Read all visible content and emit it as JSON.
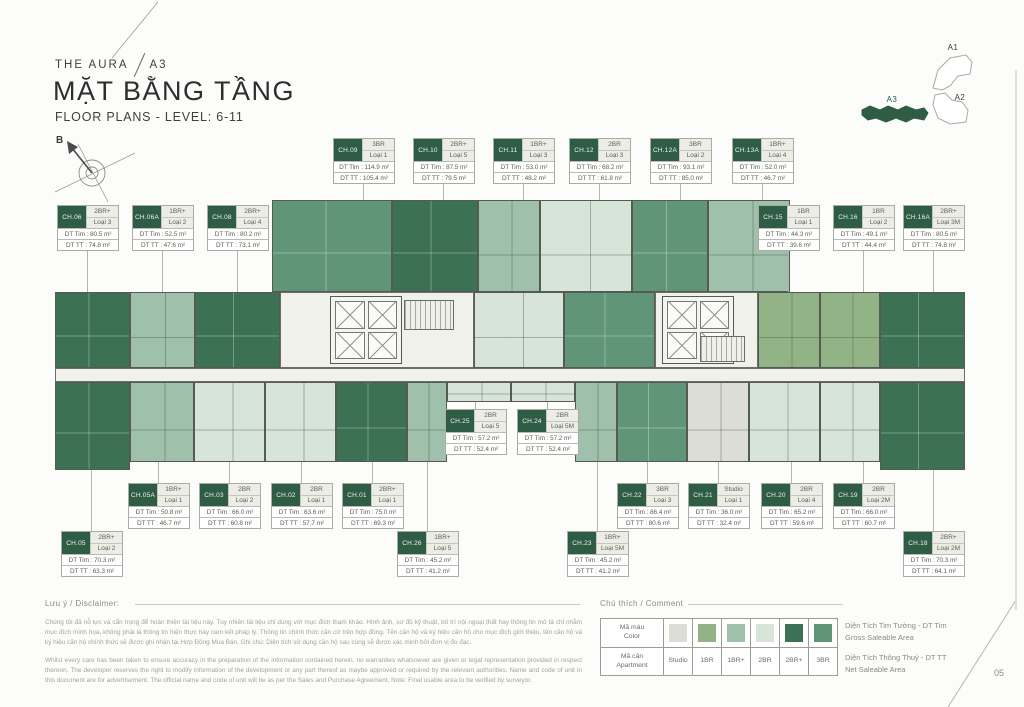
{
  "header": {
    "project": "THE AURA",
    "block": "A3",
    "title": "MẶT BẰNG TẦNG",
    "subtitle": "FLOOR PLANS - LEVEL: 6-11",
    "compass_label": "B"
  },
  "minimap": {
    "a1": "A1",
    "a2": "A2",
    "a3": "A3"
  },
  "page_number": "05",
  "labels": {
    "dt_tim": "DT Tim",
    "dt_tt": "DT TT",
    "m2": "m²"
  },
  "units": [
    {
      "code": "CH.09",
      "type": "3BR",
      "loai": "Loại 1",
      "tim": "114.9",
      "tt": "105.4",
      "x": 333,
      "y": 138,
      "dir": "down",
      "line": 18
    },
    {
      "code": "CH.10",
      "type": "2BR+",
      "loai": "Loại 5",
      "tim": "87.5",
      "tt": "79.5",
      "x": 413,
      "y": 138,
      "dir": "down",
      "line": 18
    },
    {
      "code": "CH.11",
      "type": "1BR+",
      "loai": "Loại 3",
      "tim": "53.0",
      "tt": "48.2",
      "x": 493,
      "y": 138,
      "dir": "down",
      "line": 18
    },
    {
      "code": "CH.12",
      "type": "2BR",
      "loai": "Loại 3",
      "tim": "68.2",
      "tt": "61.8",
      "x": 569,
      "y": 138,
      "dir": "down",
      "line": 18
    },
    {
      "code": "CH.12A",
      "type": "3BR",
      "loai": "Loại 2",
      "tim": "93.1",
      "tt": "85.0",
      "x": 650,
      "y": 138,
      "dir": "down",
      "line": 18
    },
    {
      "code": "CH.13A",
      "type": "1BR+",
      "loai": "Loại 4",
      "tim": "52.0",
      "tt": "46.7",
      "x": 732,
      "y": 138,
      "dir": "down",
      "line": 18
    },
    {
      "code": "CH.06",
      "type": "2BR+",
      "loai": "Loại 3",
      "tim": "80.5",
      "tt": "74.8",
      "x": 57,
      "y": 205,
      "dir": "down",
      "line": 43
    },
    {
      "code": "CH.06A",
      "type": "1BR+",
      "loai": "Loại 2",
      "tim": "52.5",
      "tt": "47.6",
      "x": 132,
      "y": 205,
      "dir": "down",
      "line": 43
    },
    {
      "code": "CH.08",
      "type": "2BR+",
      "loai": "Loại 4",
      "tim": "80.2",
      "tt": "73.1",
      "x": 207,
      "y": 205,
      "dir": "down",
      "line": 43
    },
    {
      "code": "CH.15",
      "type": "1BR",
      "loai": "Loại 1",
      "tim": "44.3",
      "tt": "39.6",
      "x": 758,
      "y": 205,
      "dir": "down",
      "line": 43
    },
    {
      "code": "CH.16",
      "type": "1BR",
      "loai": "Loại 2",
      "tim": "49.1",
      "tt": "44.4",
      "x": 833,
      "y": 205,
      "dir": "down",
      "line": 43
    },
    {
      "code": "CH.16A",
      "type": "2BR+",
      "loai": "Loại 3M",
      "tim": "80.5",
      "tt": "74.8",
      "x": 903,
      "y": 205,
      "dir": "down",
      "line": 43
    },
    {
      "code": "CH.25",
      "type": "2BR",
      "loai": "Loại 5",
      "tim": "57.2",
      "tt": "52.4",
      "x": 445,
      "y": 409,
      "dir": "up",
      "line": 7
    },
    {
      "code": "CH.24",
      "type": "2BR",
      "loai": "Loại 5M",
      "tim": "57.2",
      "tt": "52.4",
      "x": 517,
      "y": 409,
      "dir": "up",
      "line": 7
    },
    {
      "code": "CH.05A",
      "type": "1BR+",
      "loai": "Loại 1",
      "tim": "50.8",
      "tt": "46.7",
      "x": 128,
      "y": 483,
      "dir": "up",
      "line": 21
    },
    {
      "code": "CH.03",
      "type": "2BR",
      "loai": "Loại 2",
      "tim": "66.0",
      "tt": "60.8",
      "x": 199,
      "y": 483,
      "dir": "up",
      "line": 21
    },
    {
      "code": "CH.02",
      "type": "2BR",
      "loai": "Loại 1",
      "tim": "63.6",
      "tt": "57.7",
      "x": 271,
      "y": 483,
      "dir": "up",
      "line": 21
    },
    {
      "code": "CH.01",
      "type": "2BR+",
      "loai": "Loại 1",
      "tim": "75.0",
      "tt": "69.3",
      "x": 342,
      "y": 483,
      "dir": "up",
      "line": 21
    },
    {
      "code": "CH.22",
      "type": "3BR",
      "loai": "Loại 3",
      "tim": "86.4",
      "tt": "80.6",
      "x": 617,
      "y": 483,
      "dir": "up",
      "line": 21
    },
    {
      "code": "CH.21",
      "type": "Studio",
      "loai": "Loại 1",
      "tim": "36.0",
      "tt": "32.4",
      "x": 688,
      "y": 483,
      "dir": "up",
      "line": 21
    },
    {
      "code": "CH.20",
      "type": "2BR",
      "loai": "Loại 4",
      "tim": "65.2",
      "tt": "59.6",
      "x": 761,
      "y": 483,
      "dir": "up",
      "line": 21
    },
    {
      "code": "CH.19",
      "type": "2BR",
      "loai": "Loại 2M",
      "tim": "66.0",
      "tt": "60.7",
      "x": 833,
      "y": 483,
      "dir": "up",
      "line": 21
    },
    {
      "code": "CH.05",
      "type": "2BR+",
      "loai": "Loại 2",
      "tim": "70.3",
      "tt": "63.3",
      "x": 61,
      "y": 531,
      "dir": "up",
      "line": 61
    },
    {
      "code": "CH.26",
      "type": "1BR+",
      "loai": "Loại 5",
      "tim": "45.2",
      "tt": "41.2",
      "x": 397,
      "y": 531,
      "dir": "up",
      "line": 69
    },
    {
      "code": "CH.23",
      "type": "1BR+",
      "loai": "Loại 5M",
      "tim": "45.2",
      "tt": "41.2",
      "x": 567,
      "y": 531,
      "dir": "up",
      "line": 69
    },
    {
      "code": "CH.18",
      "type": "2BR+",
      "loai": "Loại 2M",
      "tim": "70.3",
      "tt": "64.1",
      "x": 903,
      "y": 531,
      "dir": "up",
      "line": 61
    }
  ],
  "floorplan": {
    "blocks": [
      {
        "x": 272,
        "y": 200,
        "w": 120,
        "h": 92,
        "t": "3BR",
        "u": "CH.09"
      },
      {
        "x": 392,
        "y": 200,
        "w": 86,
        "h": 92,
        "t": "2BR+",
        "u": "CH.10"
      },
      {
        "x": 478,
        "y": 200,
        "w": 62,
        "h": 92,
        "t": "1BR+",
        "u": "CH.11"
      },
      {
        "x": 540,
        "y": 200,
        "w": 92,
        "h": 92,
        "t": "2BR",
        "u": "CH.12"
      },
      {
        "x": 632,
        "y": 200,
        "w": 76,
        "h": 92,
        "t": "3BR",
        "u": "CH.12A"
      },
      {
        "x": 708,
        "y": 200,
        "w": 82,
        "h": 92,
        "t": "1BR+",
        "u": "CH.13A"
      },
      {
        "x": 55,
        "y": 292,
        "w": 75,
        "h": 76,
        "t": "2BR+",
        "u": "CH.06"
      },
      {
        "x": 130,
        "y": 292,
        "w": 65,
        "h": 76,
        "t": "1BR+",
        "u": "CH.06A"
      },
      {
        "x": 195,
        "y": 292,
        "w": 85,
        "h": 76,
        "t": "2BR+",
        "u": "CH.08"
      },
      {
        "x": 280,
        "y": 292,
        "w": 194,
        "h": 76,
        "t": "hall"
      },
      {
        "x": 330,
        "y": 296,
        "w": 72,
        "h": 68,
        "t": "lifts"
      },
      {
        "x": 404,
        "y": 300,
        "w": 50,
        "h": 30,
        "t": "stair"
      },
      {
        "x": 474,
        "y": 292,
        "w": 90,
        "h": 76,
        "t": "2BR"
      },
      {
        "x": 564,
        "y": 292,
        "w": 91,
        "h": 76,
        "t": "3BR"
      },
      {
        "x": 655,
        "y": 292,
        "w": 103,
        "h": 76,
        "t": "hall"
      },
      {
        "x": 662,
        "y": 296,
        "w": 72,
        "h": 68,
        "t": "lifts"
      },
      {
        "x": 700,
        "y": 336,
        "w": 45,
        "h": 26,
        "t": "stair"
      },
      {
        "x": 758,
        "y": 292,
        "w": 62,
        "h": 76,
        "t": "1BR",
        "u": "CH.15"
      },
      {
        "x": 820,
        "y": 292,
        "w": 60,
        "h": 76,
        "t": "1BR",
        "u": "CH.16"
      },
      {
        "x": 880,
        "y": 292,
        "w": 85,
        "h": 76,
        "t": "2BR+",
        "u": "CH.16A"
      },
      {
        "x": 55,
        "y": 368,
        "w": 910,
        "h": 14,
        "t": "corridor"
      },
      {
        "x": 55,
        "y": 382,
        "w": 75,
        "h": 88,
        "t": "2BR+",
        "u": "CH.05"
      },
      {
        "x": 130,
        "y": 382,
        "w": 64,
        "h": 80,
        "t": "1BR+",
        "u": "CH.05A"
      },
      {
        "x": 194,
        "y": 382,
        "w": 71,
        "h": 80,
        "t": "2BR",
        "u": "CH.03"
      },
      {
        "x": 265,
        "y": 382,
        "w": 71,
        "h": 80,
        "t": "2BR",
        "u": "CH.02"
      },
      {
        "x": 336,
        "y": 382,
        "w": 71,
        "h": 80,
        "t": "2BR+",
        "u": "CH.01"
      },
      {
        "x": 407,
        "y": 382,
        "w": 40,
        "h": 80,
        "t": "1BR+",
        "u": "CH.26"
      },
      {
        "x": 447,
        "y": 382,
        "w": 64,
        "h": 20,
        "t": "2BR",
        "u": "CH.25"
      },
      {
        "x": 511,
        "y": 382,
        "w": 64,
        "h": 20,
        "t": "2BR",
        "u": "CH.24"
      },
      {
        "x": 575,
        "y": 382,
        "w": 42,
        "h": 80,
        "t": "1BR+",
        "u": "CH.23"
      },
      {
        "x": 617,
        "y": 382,
        "w": 70,
        "h": 80,
        "t": "3BR",
        "u": "CH.22"
      },
      {
        "x": 687,
        "y": 382,
        "w": 62,
        "h": 80,
        "t": "Studio",
        "u": "CH.21"
      },
      {
        "x": 749,
        "y": 382,
        "w": 71,
        "h": 80,
        "t": "2BR",
        "u": "CH.20"
      },
      {
        "x": 820,
        "y": 382,
        "w": 60,
        "h": 80,
        "t": "2BR",
        "u": "CH.19"
      },
      {
        "x": 880,
        "y": 382,
        "w": 85,
        "h": 88,
        "t": "2BR+",
        "u": "CH.18"
      }
    ]
  },
  "disclaimer": {
    "heading": "Lưu ý / Disclaimer:",
    "vi": "Chúng tôi đã nỗ lực và cẩn trọng để hoàn thiện tài liệu này. Tuy nhiên tài liệu chỉ dùng với mục đích tham khảo. Hình ảnh, sơ đồ kỹ thuật, bố trí nội ngoại thất hay thông tin mô tả chỉ nhằm mục đích minh họa, không phải là thông tin hiện thực hay cam kết pháp lý. Thông tin chính thức căn cứ trên hợp đồng. Tên căn hộ và ký hiệu căn hộ cho mục đích giới thiệu, tên căn hộ và ký hiệu căn hộ chính thức sẽ được ghi nhận tại Hợp Đồng Mua Bán. Ghi chú: Diện tích sử dụng căn hộ sau cùng sẽ được xác minh bởi đơn vị đo đạc.",
    "en": "Whilst every care has been taken to ensure accuracy in the preparation of the information contained herein, no warranties whatsoever are given or legal representation provided in respect thereon. The developer reserves the right to modify information of the development or any part thereof as maybe approved or required by the relevant authorities. Name and code of unit in this document are for advertisement. The official name and code of unit will be as per the Sales and Purchase Agreement. Note: Final usable area to be verified by surveyor."
  },
  "legend": {
    "heading": "Chú thích / Comment",
    "color_label_vi": "Mã màu",
    "color_label_en": "Color",
    "apt_label_vi": "Mã căn",
    "apt_label_en": "Apartment",
    "types": [
      "Studio",
      "1BR",
      "1BR+",
      "2BR",
      "2BR+",
      "3BR"
    ],
    "colors": {
      "Studio": "#dcddd4",
      "1BR": "#92b386",
      "1BR+": "#9fc0ab",
      "2BR": "#d6e5d7",
      "2BR+": "#3c7154",
      "3BR": "#609578"
    },
    "notes": [
      {
        "vi": "Diện Tích Tim Tường - DT Tim",
        "en": "Gross Saleable Area"
      },
      {
        "vi": "Diện Tích Thông Thuỷ - DT TT",
        "en": "Net Saleable Area"
      }
    ]
  }
}
